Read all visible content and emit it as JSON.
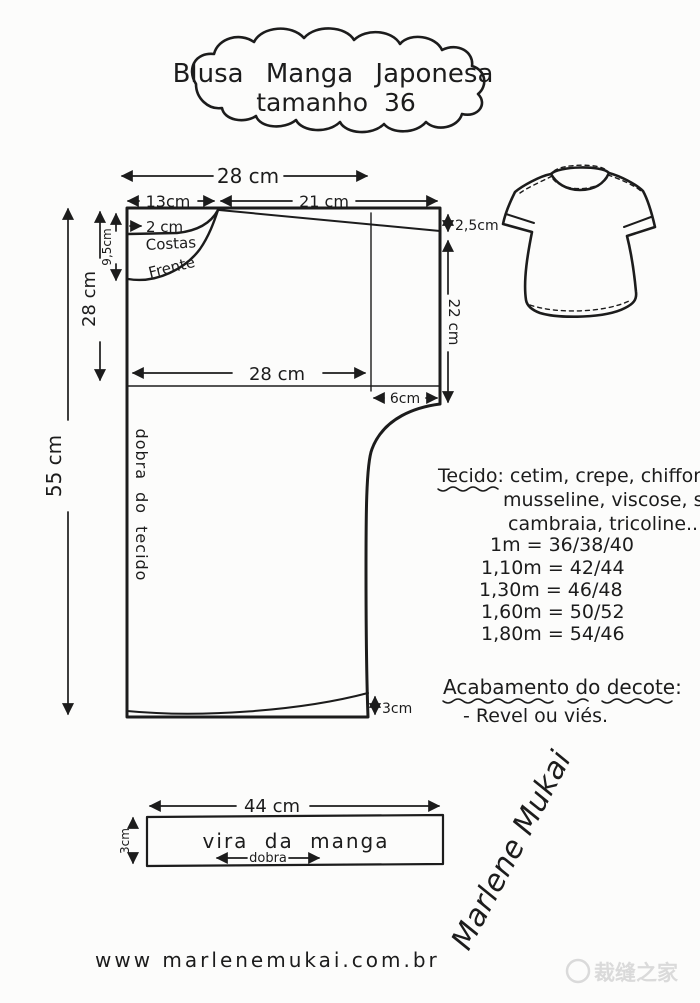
{
  "title": {
    "line1": "Blusa Manga Japonesa",
    "line2": "tamanho 36"
  },
  "pattern": {
    "labels": {
      "costas": "Costas",
      "frente": "Frente",
      "fold": "dobra do tecido"
    },
    "measurements": {
      "top_width": "28 cm",
      "back_width": "13cm",
      "sleeve_width": "21 cm",
      "back_neck_drop": "2 cm",
      "front_neck_depth": "9,5cm",
      "left_depth": "28 cm",
      "total_length": "55 cm",
      "sleeve_hem": "2,5cm",
      "side_length": "22 cm",
      "bust_width": "28 cm",
      "underarm_inset": "6cm",
      "hem_rise": "3cm"
    }
  },
  "cuff": {
    "width": "44 cm",
    "label": "vira da manga",
    "fold": "dobra",
    "height": "3cm"
  },
  "notes": {
    "fabric_lines": [
      "Tecido: cetim, crepe, chiffon,",
      "musseline, viscose, seda,",
      "cambraia, tricoline..."
    ],
    "yardage": [
      "1m = 36/38/40",
      "1,10m = 42/44",
      "1,30m = 46/48",
      "1,60m = 50/52",
      "1,80m = 54/46"
    ],
    "finish_heading": "Acabamento do decote:",
    "finish_item": "- Revel ou viés."
  },
  "footer": {
    "website": "www marlenemukai.com.br"
  },
  "signature": {
    "text": "Marlene Mukai"
  },
  "watermark": {
    "text": "裁缝之家",
    "icon": "sewing-logo-icon"
  }
}
